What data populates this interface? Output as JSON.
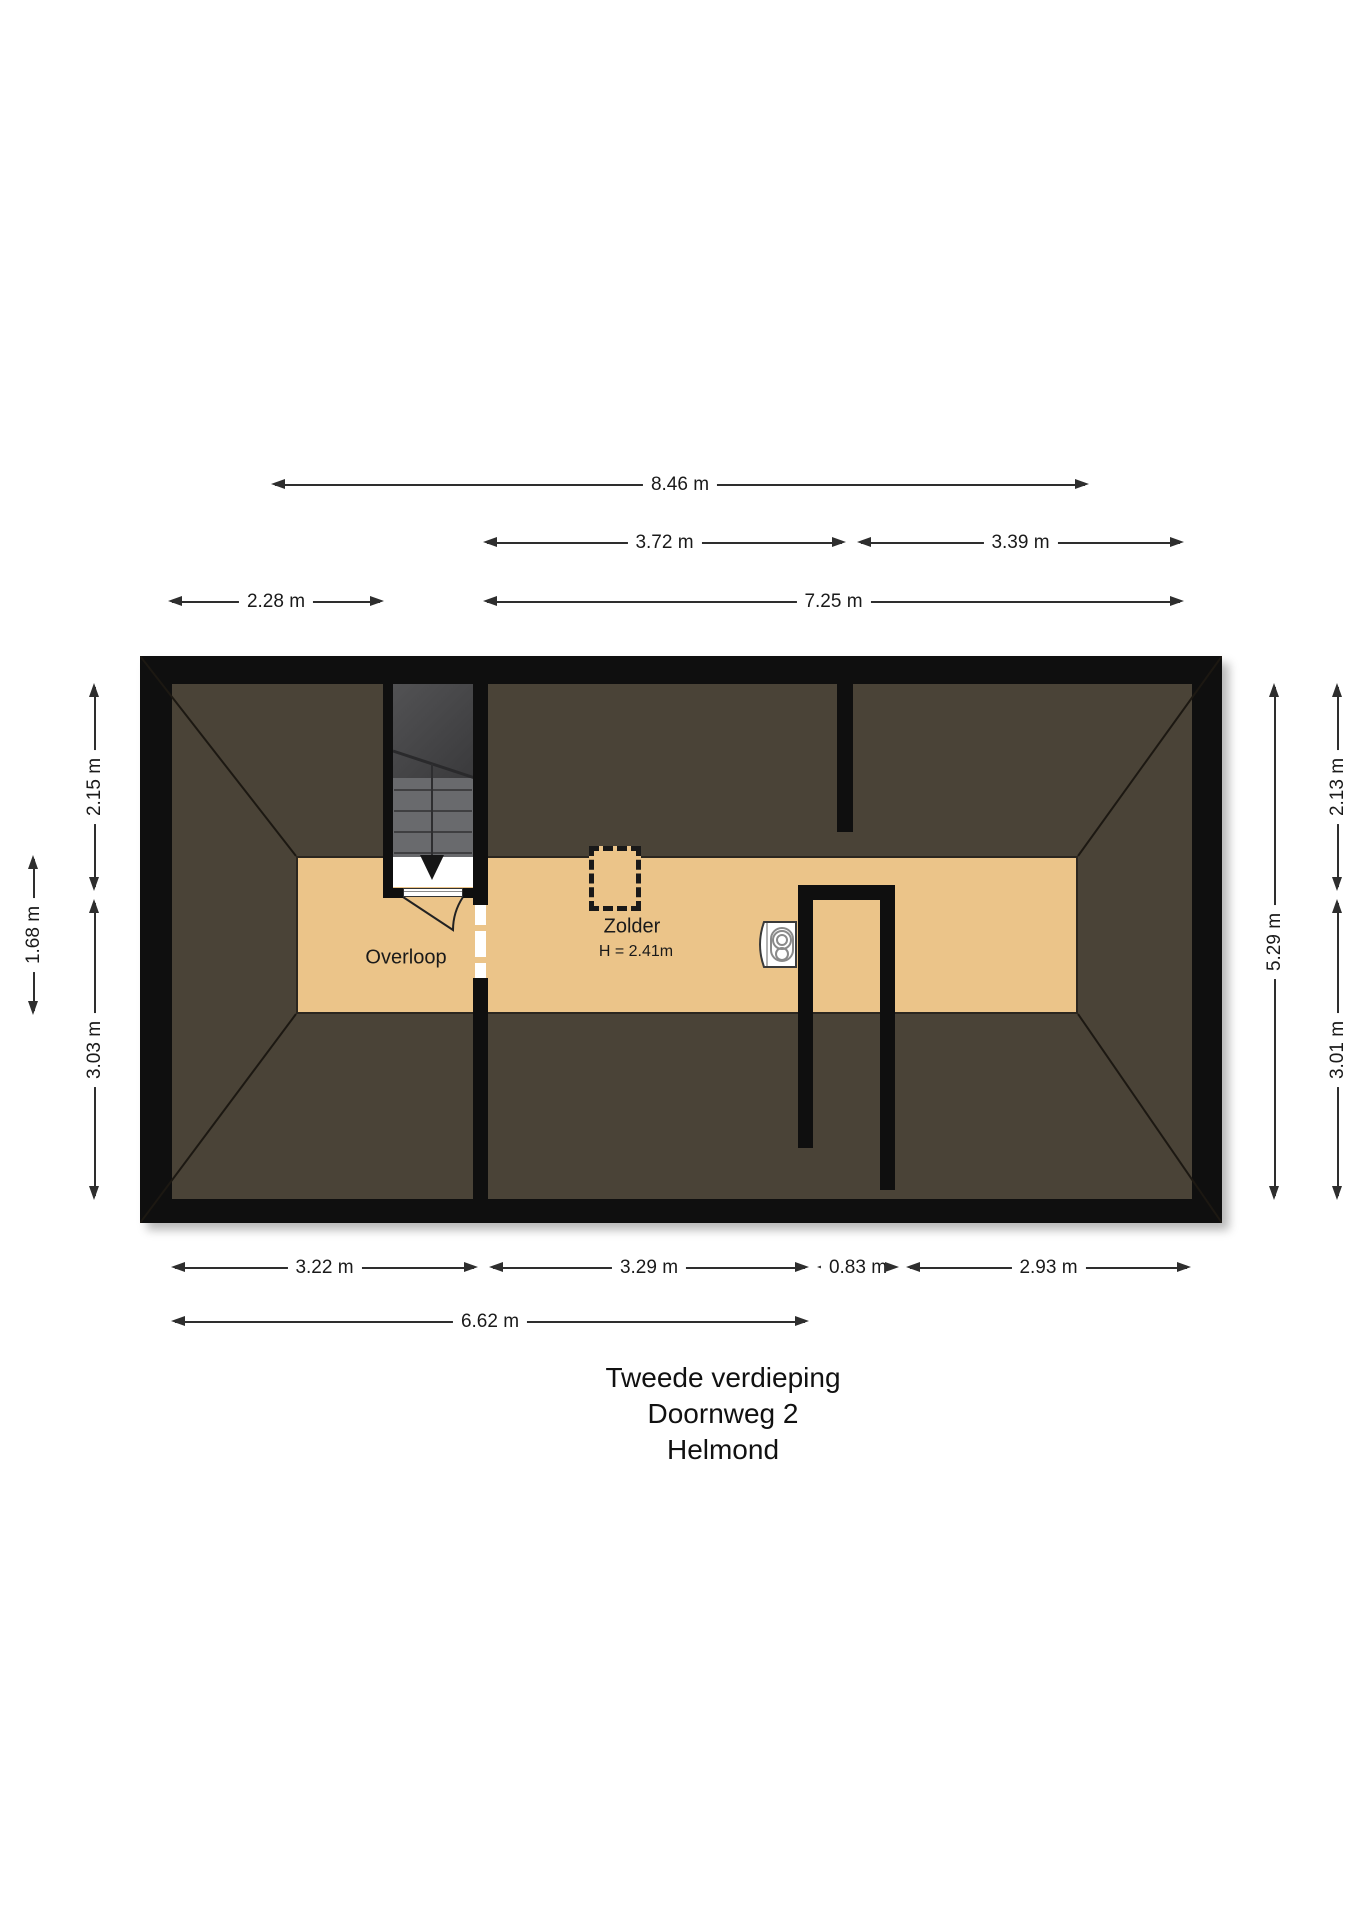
{
  "title_block": {
    "lines": [
      "Tweede verdieping",
      "Doornweg 2",
      "Helmond"
    ]
  },
  "rooms": [
    {
      "id": "overloop",
      "label": "Overloop"
    },
    {
      "id": "zolder",
      "label": "Zolder",
      "ceiling_height": "H = 2.41m"
    }
  ],
  "dimensions": {
    "horizontal": [
      {
        "label": "8.46 m",
        "x1": 272,
        "x2": 1088,
        "y": 485
      },
      {
        "label": "3.72 m",
        "x1": 484,
        "x2": 845,
        "y": 543
      },
      {
        "label": "3.39 m",
        "x1": 858,
        "x2": 1183,
        "y": 543
      },
      {
        "label": "2.28 m",
        "x1": 169,
        "x2": 383,
        "y": 602
      },
      {
        "label": "7.25 m",
        "x1": 484,
        "x2": 1183,
        "y": 602
      },
      {
        "label": "3.22 m",
        "x1": 172,
        "x2": 477,
        "y": 1268
      },
      {
        "label": "3.29 m",
        "x1": 490,
        "x2": 808,
        "y": 1268
      },
      {
        "label": "0.83 m",
        "x1": 818,
        "x2": 898,
        "y": 1268
      },
      {
        "label": "2.93 m",
        "x1": 907,
        "x2": 1190,
        "y": 1268
      },
      {
        "label": "6.62 m",
        "x1": 172,
        "x2": 808,
        "y": 1322
      }
    ],
    "vertical": [
      {
        "label": "2.15 m",
        "y1": 684,
        "y2": 890,
        "x": 95
      },
      {
        "label": "3.03 m",
        "y1": 900,
        "y2": 1199,
        "x": 95
      },
      {
        "label": "1.68 m",
        "y1": 856,
        "y2": 1014,
        "x": 34
      },
      {
        "label": "5.29 m",
        "y1": 684,
        "y2": 1199,
        "x": 1275
      },
      {
        "label": "2.13 m",
        "y1": 684,
        "y2": 890,
        "x": 1338
      },
      {
        "label": "3.01 m",
        "y1": 900,
        "y2": 1199,
        "x": 1338
      }
    ]
  },
  "icons": {
    "boiler": "boiler-icon",
    "chimney": "chimney-dashed-icon",
    "stair_arrow": "stair-down-arrow-icon"
  },
  "colors": {
    "wall": "#0f0f0f",
    "roof_slope": "#4a4337",
    "floor": "#ebc489",
    "floor_edge": "#2b261f",
    "dim_line": "#2e2e2e",
    "text": "#1a1a1a",
    "stair_dark": "#424244",
    "stair_light": "#696a6d"
  }
}
